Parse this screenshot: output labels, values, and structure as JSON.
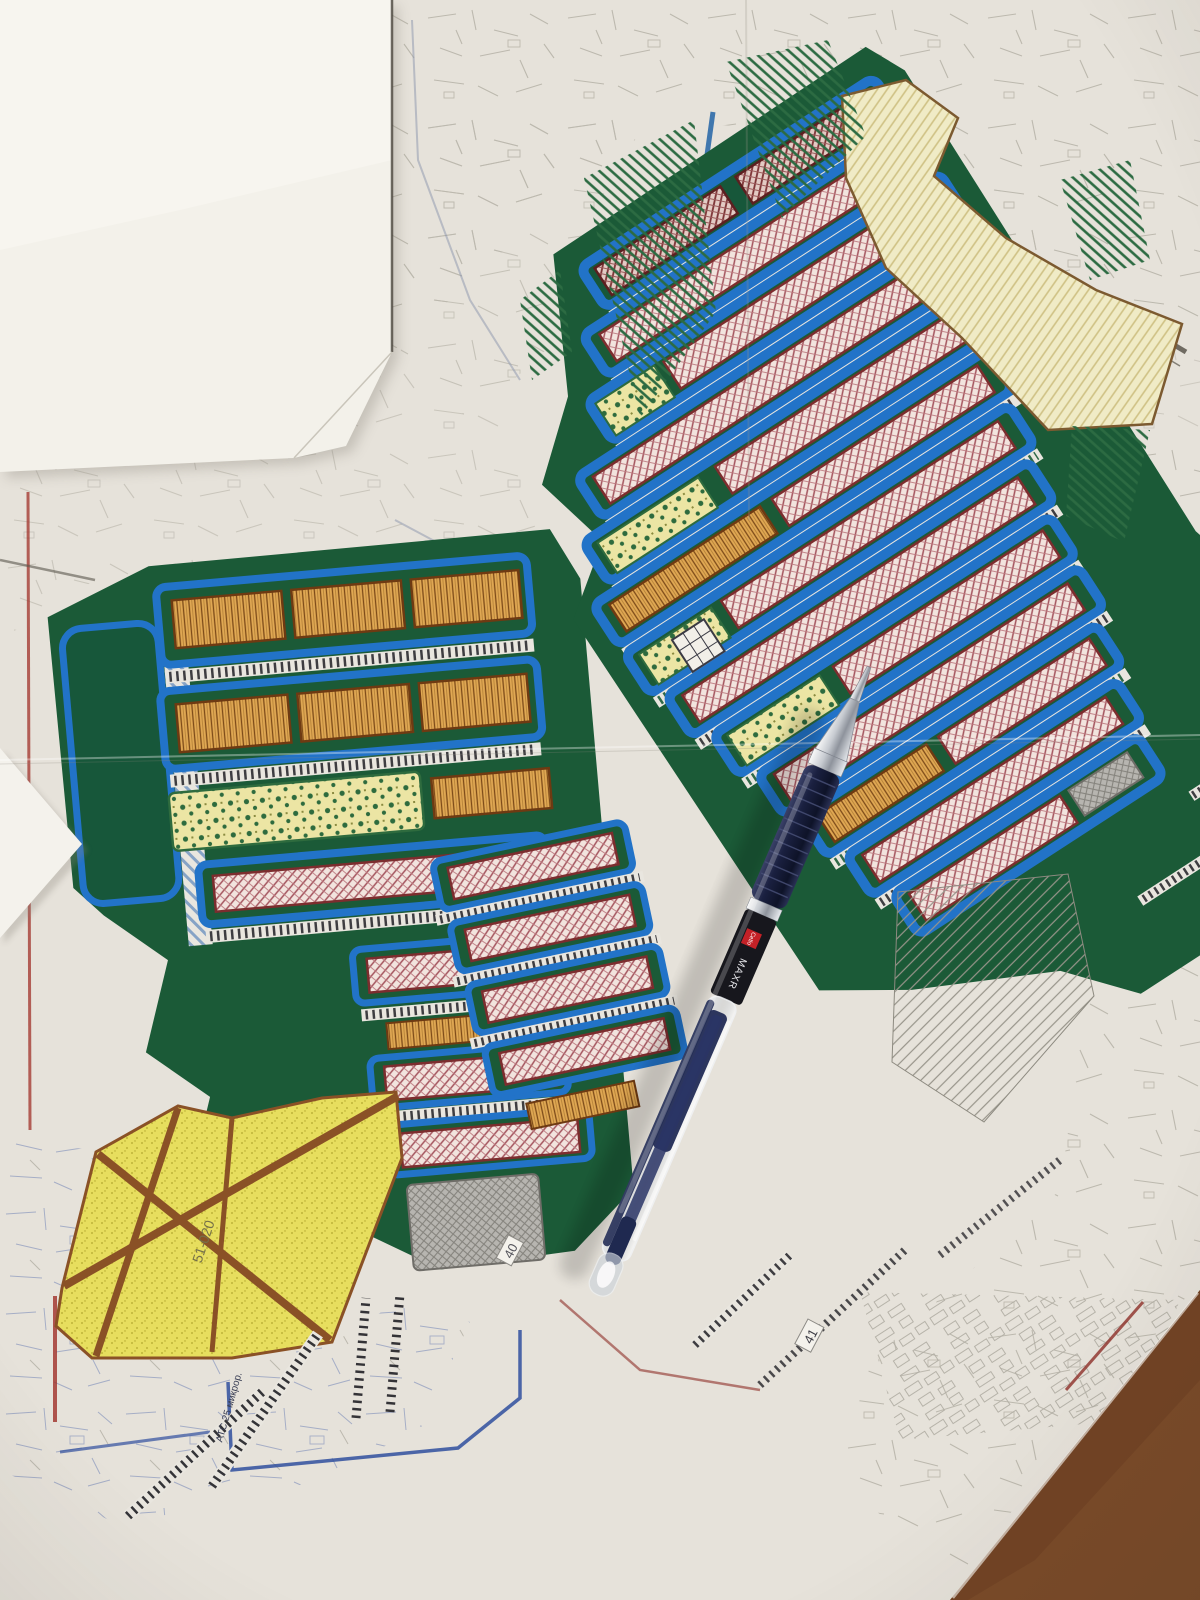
{
  "map": {
    "labels": {
      "zone_bottom_left": "51-020",
      "block_40": "40",
      "block_41": "41",
      "railway_note": "АТС 25 микрор.",
      "legend_hint": ""
    },
    "palette": {
      "paper": "#e6e2da",
      "blank_sheet": "#f3f1ea",
      "table_brown": "#7a4a28",
      "road_blue": "#2273c8",
      "block_green": "#1b5a37",
      "building_pink_hatch": "#a3525c",
      "building_orange": "#e0a853",
      "building_dark_red": "#7c3234",
      "courtyard_yellow": "#ece5a4",
      "zone_yellow": "#e7de5e",
      "pale_yellow_zone": "#f0ebc6",
      "gray_block": "#b7b5b0",
      "road_white": "#e9e6df",
      "red_line": "#a03028",
      "blue_line": "#2f4f9e"
    }
  },
  "pen": {
    "brand": "Cello",
    "model": "MAXR",
    "body_color": "#1a2040",
    "logo_color": "#c42127"
  }
}
